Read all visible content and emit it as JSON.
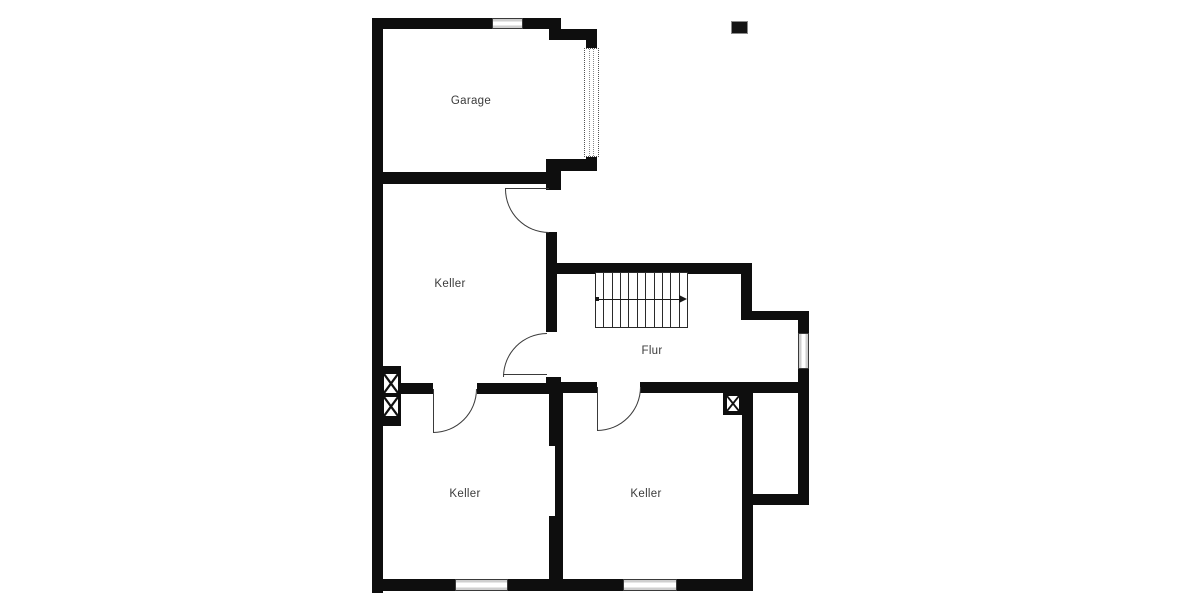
{
  "floor_plan": {
    "rooms": [
      {
        "id": "garage",
        "label": "Garage"
      },
      {
        "id": "keller-mitte",
        "label": "Keller"
      },
      {
        "id": "flur",
        "label": "Flur"
      },
      {
        "id": "keller-unten-links",
        "label": "Keller"
      },
      {
        "id": "keller-unten-rechts",
        "label": "Keller"
      }
    ],
    "colors": {
      "wall": "#0e0e0e",
      "background": "#ffffff",
      "label_text": "#3b3b3b",
      "window_fill": "#cfcfcf"
    },
    "symbols": {
      "stairs_treads": 11,
      "stairs_direction": "right",
      "chimney_count": 3,
      "door_count": 4,
      "window_count": 4,
      "garage_door_count": 1
    }
  }
}
